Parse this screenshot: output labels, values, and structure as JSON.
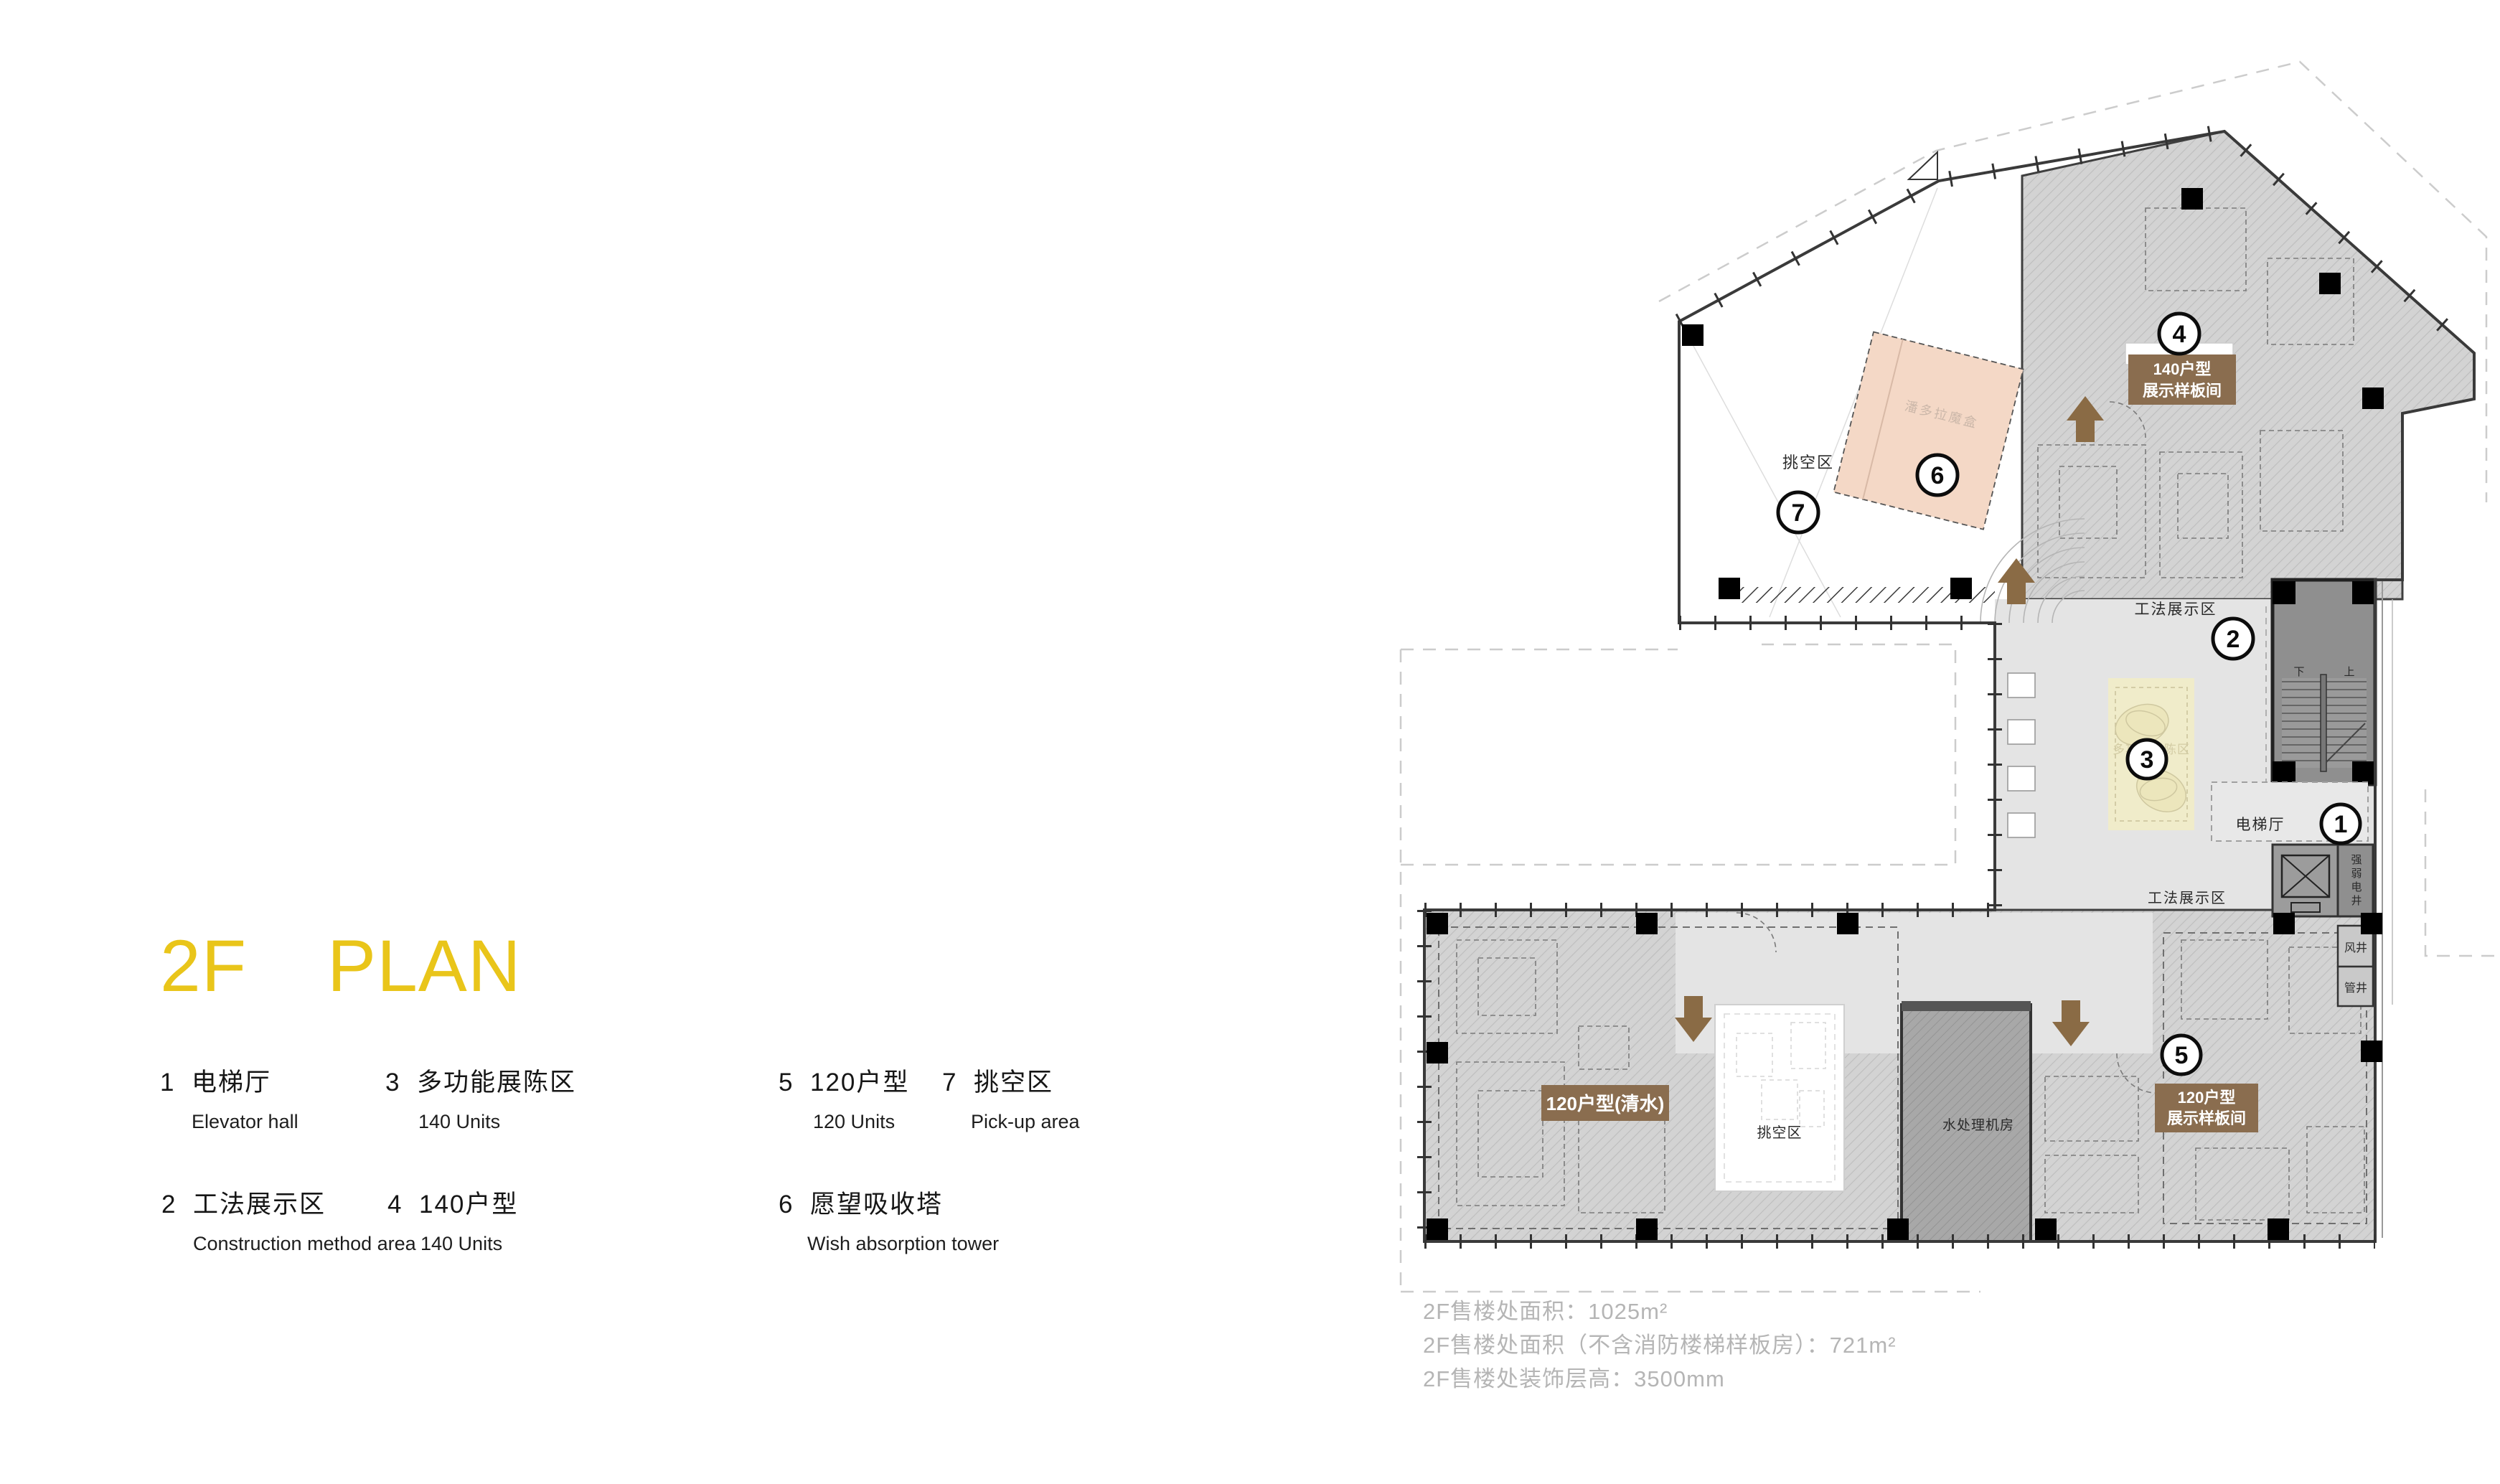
{
  "title": {
    "floor": "2F",
    "word": "PLAN"
  },
  "legend": {
    "items": [
      {
        "num": "1",
        "zh": "电梯厅",
        "en": "Elevator hall"
      },
      {
        "num": "2",
        "zh": "工法展示区",
        "en": "Construction method area"
      },
      {
        "num": "3",
        "zh": "多功能展陈区",
        "en": "140 Units"
      },
      {
        "num": "4",
        "zh": "140户型",
        "en": "140 Units"
      },
      {
        "num": "5",
        "zh": "120户型",
        "en": "120 Units"
      },
      {
        "num": "6",
        "zh": "愿望吸收塔",
        "en": "Wish absorption tower"
      },
      {
        "num": "7",
        "zh": "挑空区",
        "en": "Pick-up area"
      }
    ]
  },
  "stats": {
    "line1": "2F售楼处面积：1025m²",
    "line2": "2F售楼处面积（不含消防楼梯样板房）：721m²",
    "line3": "2F售楼处装饰层高：3500mm"
  },
  "plan": {
    "circles": {
      "n1": "1",
      "n2": "2",
      "n3": "3",
      "n4": "4",
      "n5": "5",
      "n6": "6",
      "n7": "7"
    },
    "labels": {
      "void_top": "挑空区",
      "pandora": "潘多拉魔盒",
      "method_top": "工法展示区",
      "method_bottom": "工法展示区",
      "multi": "多功能展陈区",
      "elevator_hall": "电梯厅",
      "shaft_power": "强弱电井",
      "shaft_air": "风井",
      "shaft_pipe": "管井",
      "water_room": "水处理机房",
      "void_bottom": "挑空区",
      "stair_down": "下",
      "stair_up": "上"
    },
    "tags": {
      "t140_line1": "140户型",
      "t140_line2": "展示样板间",
      "t120_raw": "120户型(清水)",
      "t120_line1": "120户型",
      "t120_line2": "展示样板间"
    },
    "colors": {
      "accent_yellow": "#e9c51a",
      "tag_brown": "#8a6d4f",
      "arrow_brown": "#8a6b45",
      "pandora_pink": "#f4d8c6",
      "mat_yellow": "#f0ecca",
      "hall_gray": "#e4e4e4",
      "stair_gray": "#8f8f8f"
    }
  }
}
